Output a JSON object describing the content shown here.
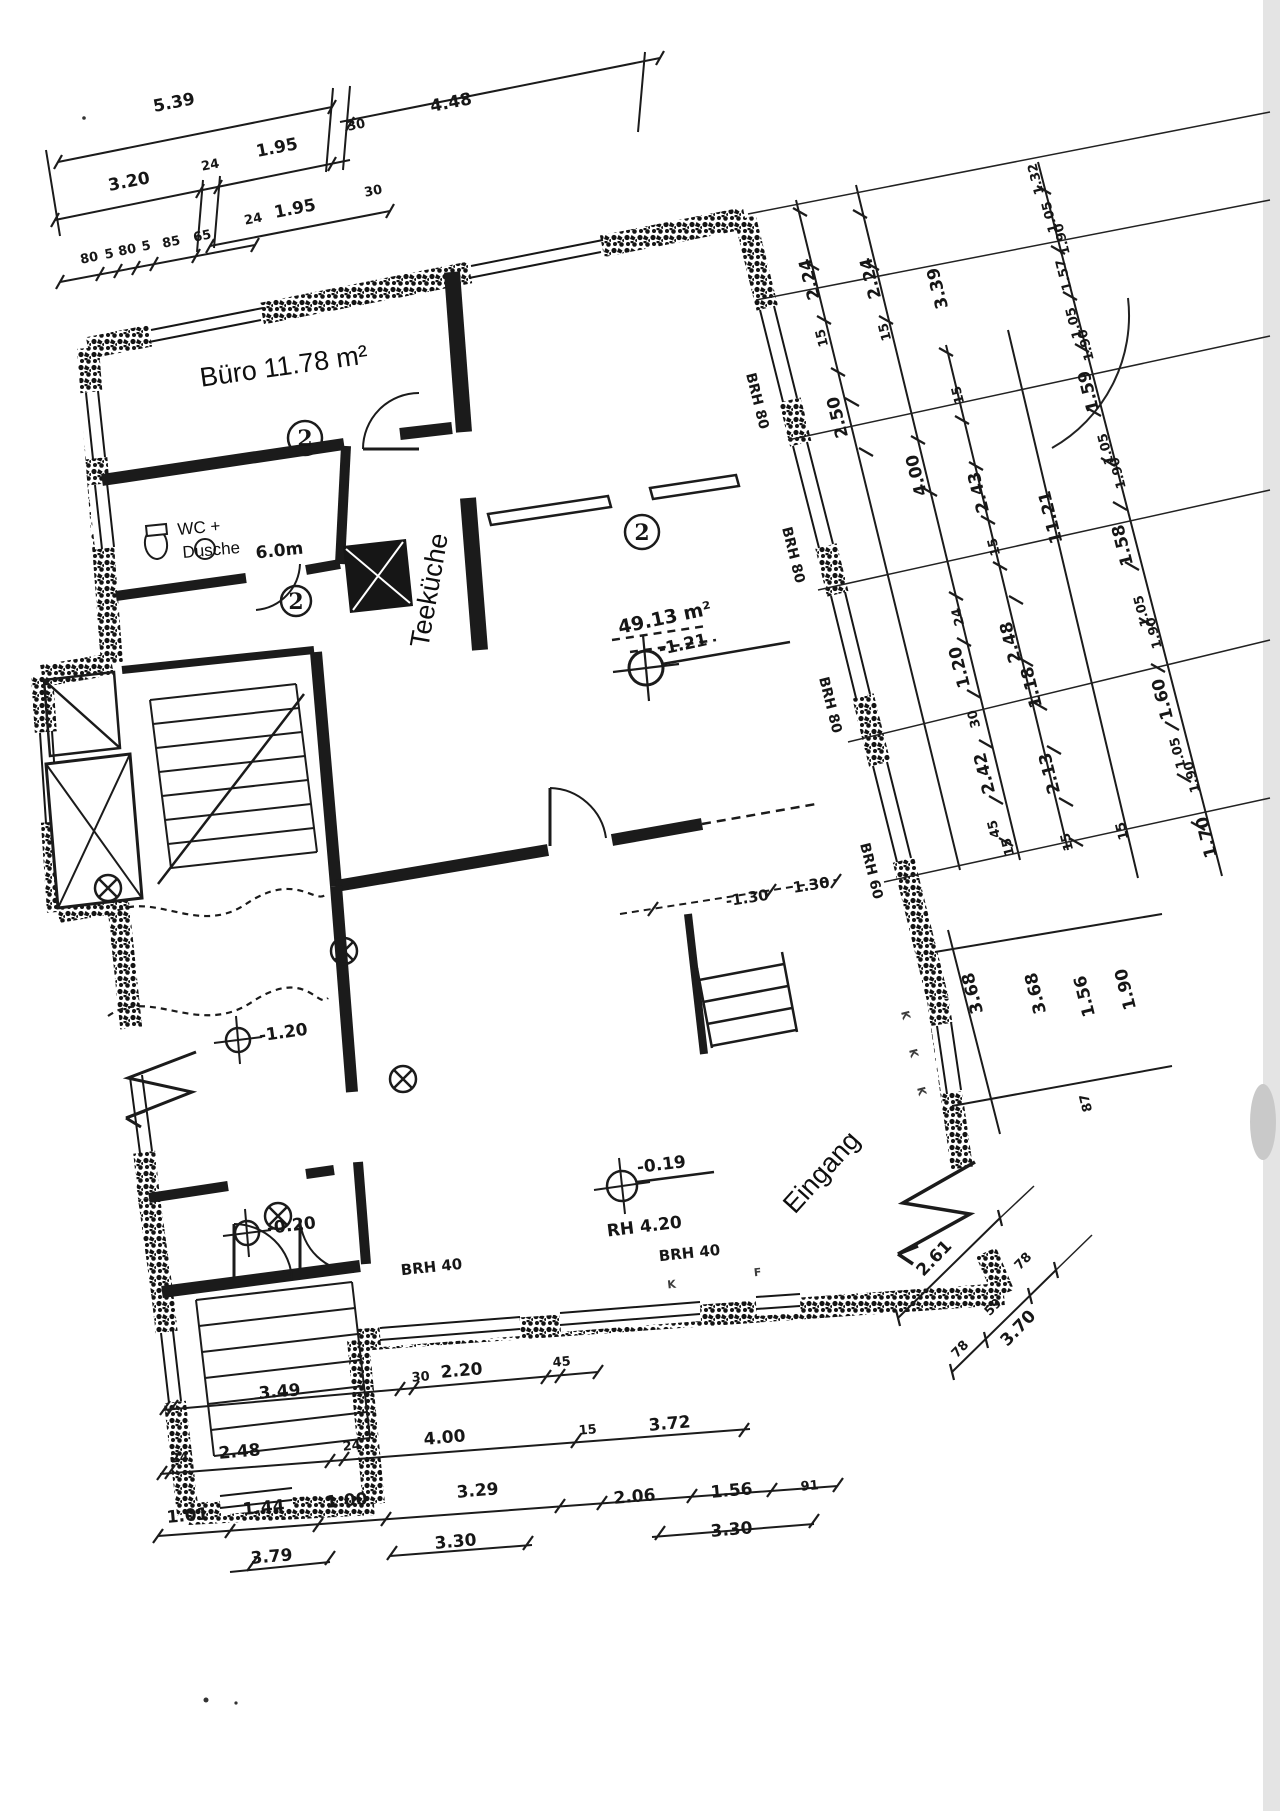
{
  "rooms": {
    "buero": {
      "label": "Büro 11.78 m²",
      "circle": "2"
    },
    "wc": {
      "line1": "WC +",
      "line2": "Dusche",
      "area": "6.0m",
      "circle": "2"
    },
    "teekueche": {
      "label": "Teeküche"
    },
    "hall": {
      "area": "49.13 m²",
      "level": "-1.21",
      "circle": "2"
    },
    "entrance": {
      "label": "Eingang"
    }
  },
  "levels": {
    "l1": "-1.20",
    "l2": "-0.20",
    "l3": "-0.19",
    "rh": "RH 4.20"
  },
  "sills": {
    "r1": "BRH 80",
    "r2": "BRH 80",
    "r3": "BRH 80",
    "r4": "BRH 60",
    "b1": "BRH 40",
    "b2": "BRH 40"
  },
  "marks": {
    "k1": "K",
    "k2": "K",
    "k3": "K",
    "bk": "K",
    "bf": "F"
  },
  "stair_opening": {
    "neg": "-1.30",
    "pos": "1.30"
  },
  "dims": {
    "top1": [
      "5.39",
      "4.48"
    ],
    "top2": [
      "3.20",
      "24",
      "1.95",
      "30"
    ],
    "top3": [
      "24",
      "1.95",
      "30"
    ],
    "top4": [
      "80",
      "5",
      "80",
      "5",
      "85",
      "65"
    ],
    "right_a": [
      "2.24",
      "15",
      "2.24",
      "15",
      "3.39"
    ],
    "right_b": [
      "2.50",
      "4.00"
    ],
    "right_c": [
      "15",
      "2.43",
      "15",
      "24",
      "1.20",
      "30",
      "2.42",
      "45",
      "15"
    ],
    "right_d": [
      "11.21",
      "2.48",
      "1.18",
      "2.13",
      "15"
    ],
    "right_e": [
      "1.32",
      "1.05",
      "1.90",
      "1.57",
      "1.05",
      "1.90",
      "1.59",
      "1.05",
      "1.90",
      "1.58",
      "1.05",
      "1.90",
      "1.60",
      "1.05",
      "1.90",
      "15",
      "1.70"
    ],
    "right_f": [
      "3.68",
      "3.68",
      "1.56",
      "1.90",
      "87"
    ],
    "bottom1": [
      "3.49",
      "30",
      "2.20",
      "45"
    ],
    "bottom2": [
      "24",
      "2.48",
      "24",
      "4.00",
      "15",
      "3.72"
    ],
    "bottom3": [
      "1.01",
      "1.44",
      "1.00",
      "3.29",
      "2.06",
      "1.56",
      "91"
    ],
    "bottom4": [
      "3.79",
      "3.30",
      "3.30"
    ],
    "entry1": [
      "2.61"
    ],
    "entry2": [
      "78",
      "59",
      "78"
    ],
    "entry_total": "3.70"
  }
}
